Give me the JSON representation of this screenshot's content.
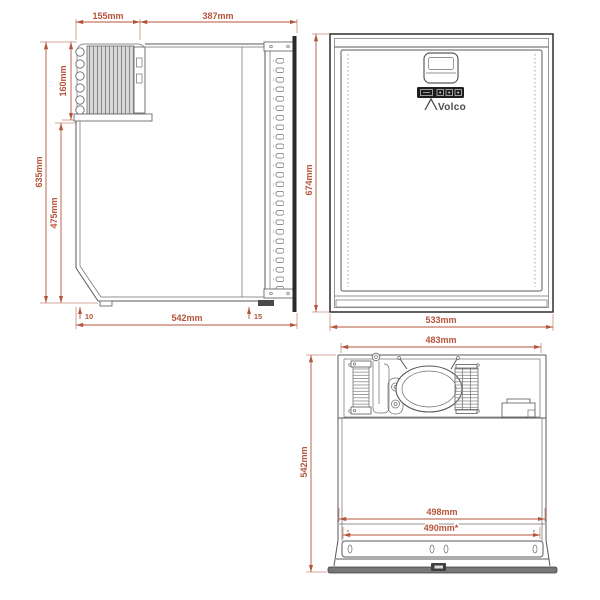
{
  "brand": {
    "logo_text": "Volco"
  },
  "colors": {
    "dimension_red": "#b5543b",
    "drawing_gray": "#5a5a5a",
    "panel_black": "#1e1e1e"
  },
  "control_panel": {
    "icons": [
      "display-icon",
      "button-icon",
      "button-icon",
      "button-icon"
    ]
  },
  "views": {
    "side": {
      "dims": {
        "top_condenser_depth": "155mm",
        "top_body_depth": "387mm",
        "condenser_height": "160mm",
        "overall_height": "635mm",
        "body_height": "475mm",
        "foot_offset": "10",
        "overall_depth": "542mm",
        "door_bottom_offset": "15"
      }
    },
    "front": {
      "dims": {
        "overall_height": "674mm",
        "overall_width": "533mm"
      }
    },
    "top": {
      "dims": {
        "inner_width": "483mm",
        "overall_depth": "542mm",
        "cutout_width": "498mm",
        "door_inner_width": "490mm*"
      }
    }
  }
}
